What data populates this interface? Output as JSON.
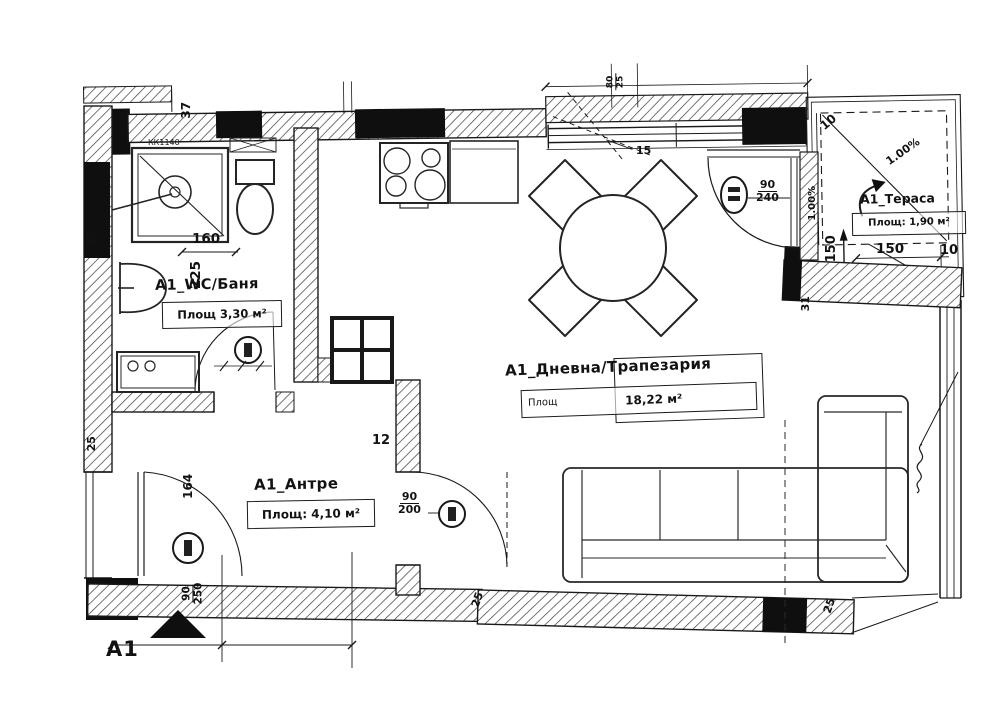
{
  "rooms": {
    "wc": {
      "title": "А1_WC/Баня",
      "area": "Площ 3,30 м²"
    },
    "antre": {
      "title": "А1_Антре",
      "area": "Площ: 4,10 м²"
    },
    "living": {
      "title": "А1_Дневна/Трапезария",
      "area_label": "Площ",
      "area_value": "18,22 м²"
    },
    "terrace": {
      "title": "А1_Тераса",
      "area": "Площ: 1,90 м²"
    }
  },
  "marker": {
    "label": "A1"
  },
  "dims": {
    "top_left_37": "37",
    "shelf_code": "КК1140",
    "bath_160": "160",
    "bath_225": "225",
    "left_25_top": "25",
    "left_25_bottom": "25",
    "entry_164": "164",
    "entry_door_w": "90",
    "entry_door_h": "250",
    "antre_12": "12",
    "antre_door_w": "90",
    "antre_door_h": "200",
    "window_15": "15",
    "top_80": "80",
    "top_25": "25",
    "balcony_door_w": "90",
    "balcony_door_h": "240",
    "slope_diag": "1.00%",
    "slope_vert": "1.00%",
    "terrace_150_v": "150",
    "terrace_150_h": "150",
    "terrace_10_top": "10",
    "terrace_10_right": "10",
    "terrace_31": "31",
    "bottom_25_a": "25",
    "bottom_25_b": "25"
  },
  "colors": {
    "ink": "#1e1e1e",
    "paper": "#ffffff"
  }
}
